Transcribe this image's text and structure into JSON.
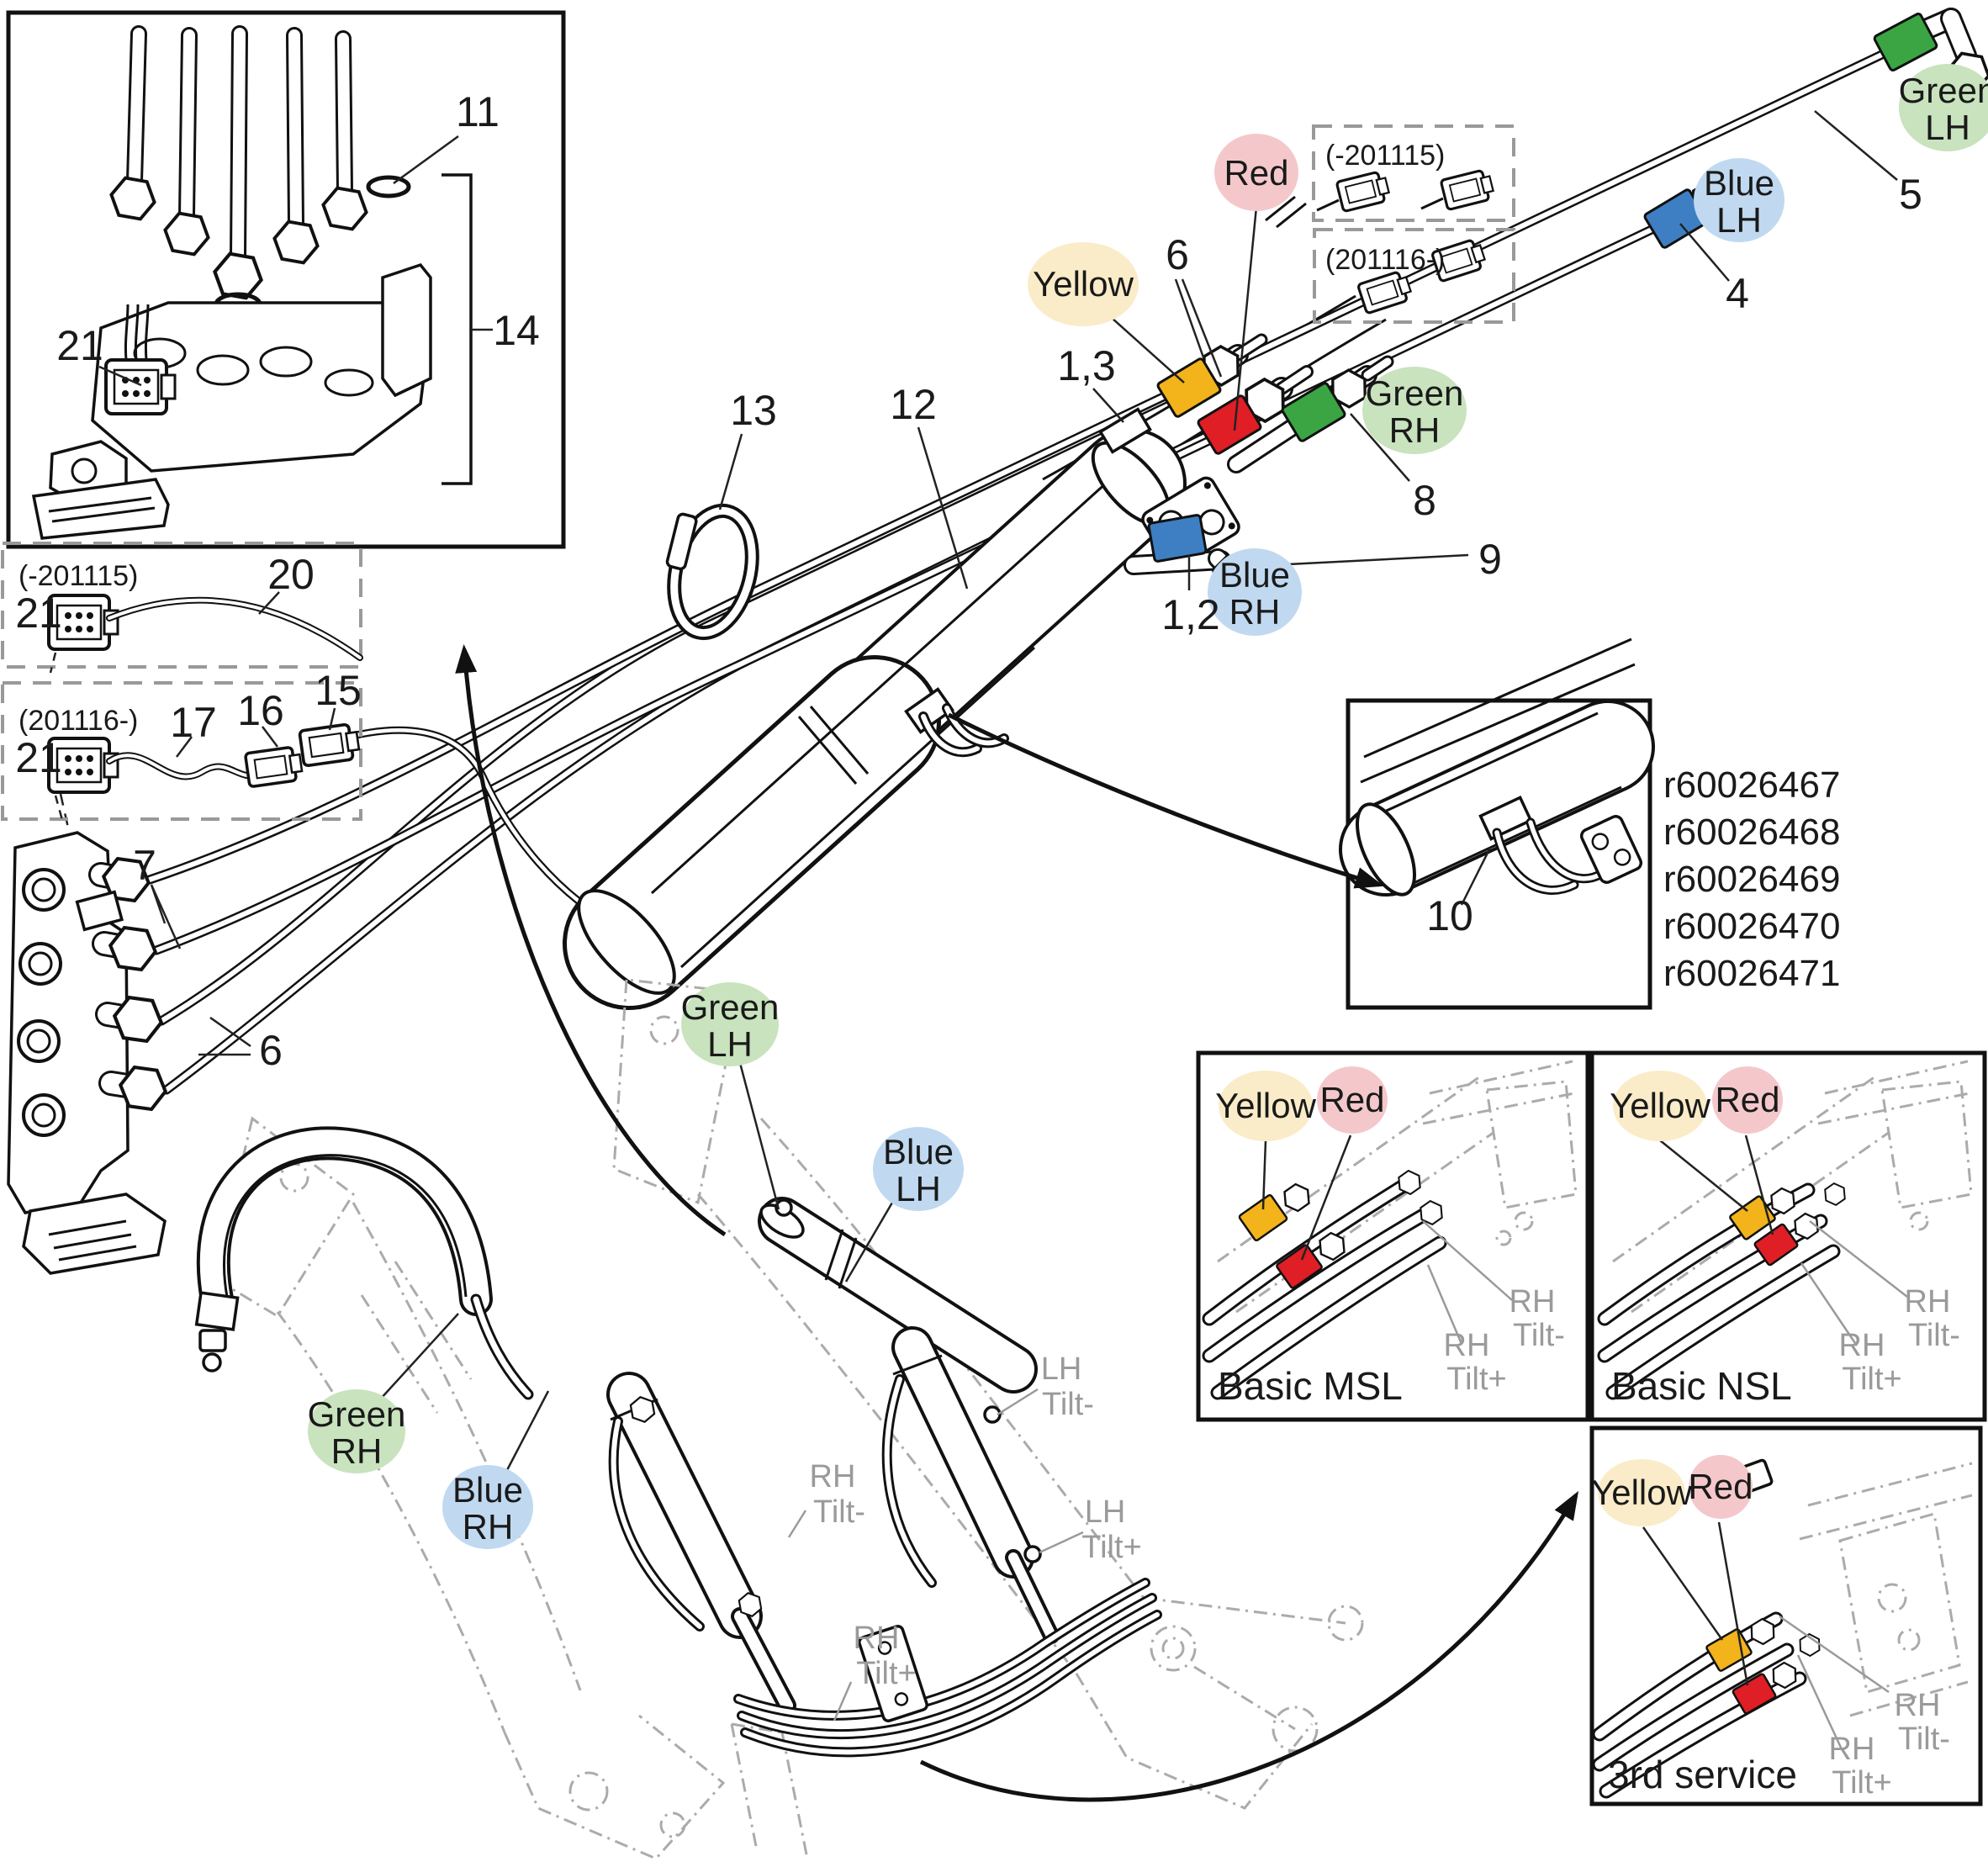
{
  "diagram": {
    "callouts": {
      "c1_2": "1,2",
      "c1_3": "1,3",
      "c4": "4",
      "c5": "5",
      "c6": "6",
      "c7": "7",
      "c8": "8",
      "c9": "9",
      "c10": "10",
      "c11": "11",
      "c12": "12",
      "c13": "13",
      "c14": "14",
      "c15": "15",
      "c16": "16",
      "c17": "17",
      "c20": "20",
      "c21": "21"
    },
    "serial_ranges": {
      "early": "(-201115)",
      "late": "(201116-)"
    },
    "color_words": {
      "yellow": "Yellow",
      "red": "Red",
      "green": "Green",
      "blue": "Blue"
    },
    "side_words": {
      "lh": "LH",
      "rh": "RH"
    },
    "tilt_words": {
      "minus": "Tilt-",
      "plus": "Tilt+"
    },
    "variant_titles": {
      "basic_msl": "Basic MSL",
      "basic_nsl": "Basic NSL",
      "third_service": "3rd service"
    },
    "part_numbers": [
      "r60026467",
      "r60026468",
      "r60026469",
      "r60026470",
      "r60026471"
    ],
    "band_colors": {
      "yellow": "#F2B31B",
      "red": "#E01E25",
      "green": "#3BA544",
      "blue": "#3D7FC2"
    },
    "highlight_colors": {
      "yellow": "#FAECC8",
      "red": "#F4C8CB",
      "green": "#C8E3BE",
      "blue": "#C0D9F0"
    }
  }
}
